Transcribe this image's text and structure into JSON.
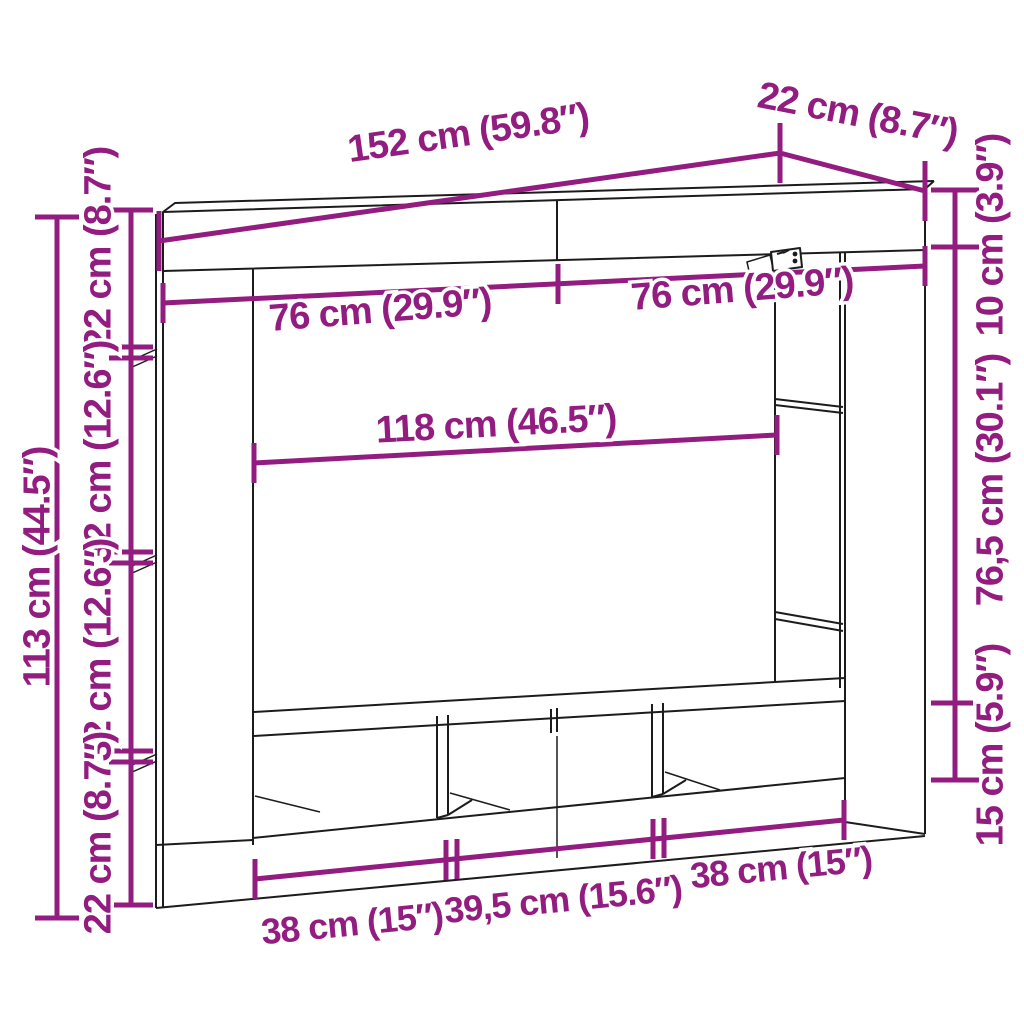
{
  "diagram": {
    "type": "furniture-dimension-diagram",
    "subject": "wall-mounted TV media unit, perspective line drawing",
    "colors": {
      "dimension_accent": "#921C80",
      "outline": "#1c1c1c",
      "background": "#ffffff"
    }
  },
  "dims": {
    "top_width": "152 cm (59.8″)",
    "depth": "22 cm (8.7″)",
    "cabinet_left_half": "76 cm (29.9″)",
    "cabinet_right_half": "76 cm (29.9″)",
    "niche_width": "118 cm (46.5″)",
    "right_top_height": "10 cm (3.9″)",
    "right_middle_height": "76,5 cm (30.1″)",
    "right_bottom_height": "15 cm (5.9″)",
    "left_total_height": "113 cm (44.5″)",
    "left_seg_1": "22 cm (8.7″)",
    "left_seg_2": "32 cm (12.6″)",
    "left_seg_3": "32 cm (12.6″)",
    "left_seg_4": "22 cm (8.7″)",
    "bottom_seg_1": "38 cm (15″)",
    "bottom_seg_2": "39,5 cm (15.6″)",
    "bottom_seg_3": "38 cm (15″)"
  }
}
